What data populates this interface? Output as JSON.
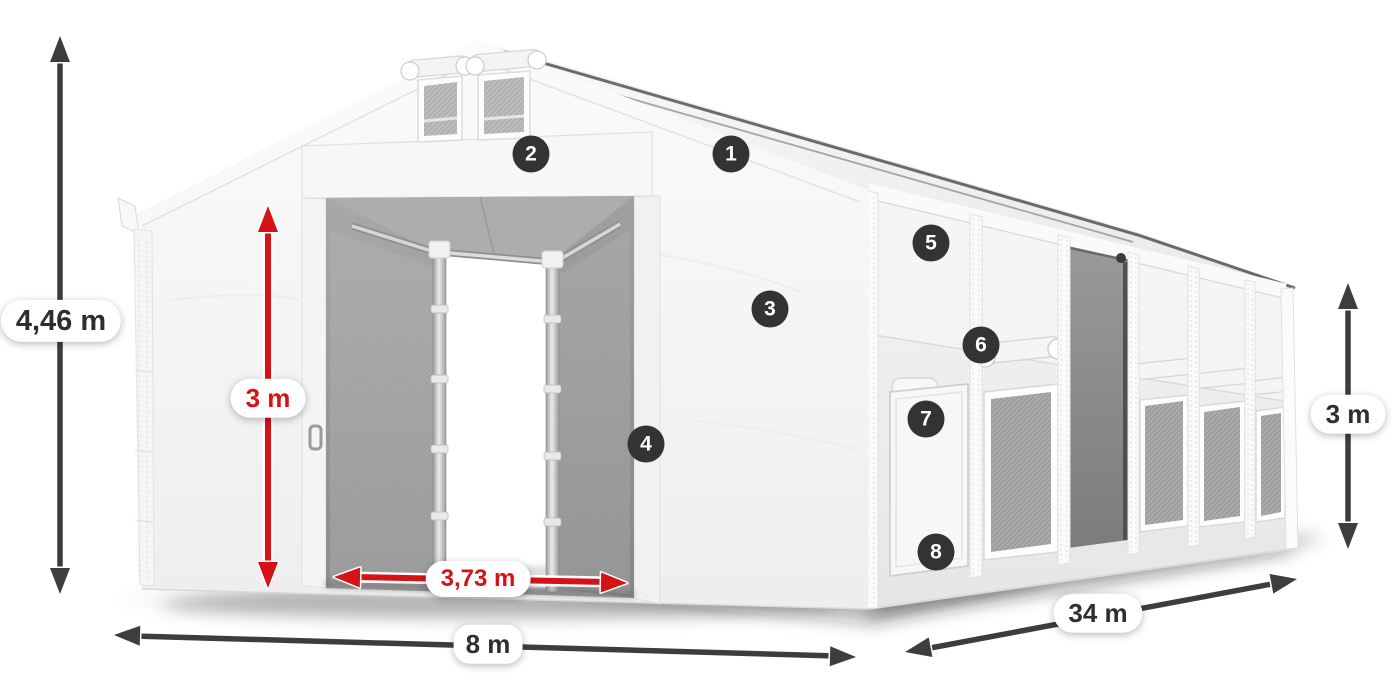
{
  "diagram": {
    "subject": "white storage tent with open gable entrance, numbered feature hotspots and dimension arrows"
  },
  "dimensions": {
    "total_height": {
      "label": "4,46 m"
    },
    "entrance_height": {
      "label": "3 m"
    },
    "entrance_width": {
      "label": "3,73 m"
    },
    "width": {
      "label": "8 m"
    },
    "length": {
      "label": "34 m"
    },
    "side_height": {
      "label": "3 m"
    }
  },
  "badges": [
    {
      "number": "1"
    },
    {
      "number": "2"
    },
    {
      "number": "3"
    },
    {
      "number": "4"
    },
    {
      "number": "5"
    },
    {
      "number": "6"
    },
    {
      "number": "7"
    },
    {
      "number": "8"
    }
  ],
  "colors": {
    "accent_red": "#d51317",
    "arrow_gray": "#3d3d3d",
    "badge_bg": "#333333",
    "badge_text": "#ffffff",
    "page_bg": "#ffffff"
  }
}
